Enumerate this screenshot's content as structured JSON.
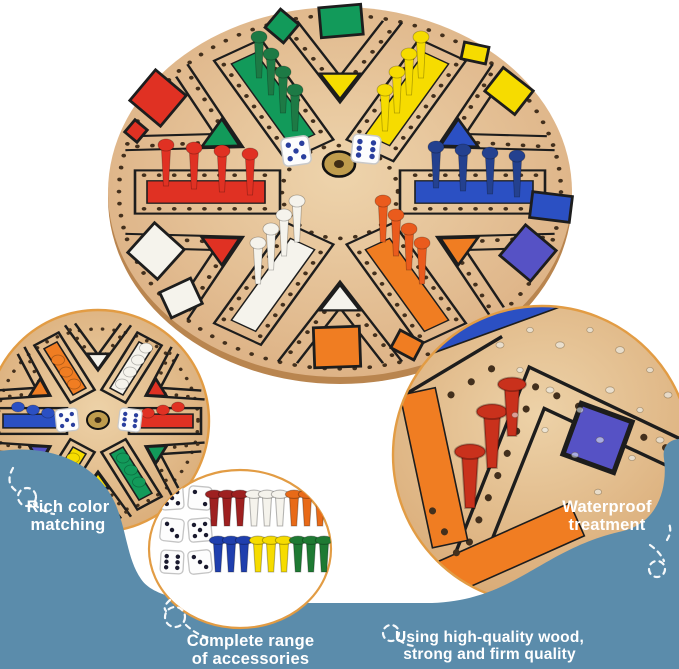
{
  "captions": {
    "rich_color": {
      "line1": "Rich color",
      "line2": "matching"
    },
    "waterproof": {
      "line1": "Waterproof",
      "line2": "treatment"
    },
    "accessories": {
      "line1": "Complete range",
      "line2": "of accessories"
    },
    "quality": {
      "line1": "Using high-quality wood,",
      "line2": "strong and firm quality"
    }
  },
  "colors": {
    "background_blue": "#5b8cab",
    "circle_border": "#e29c44",
    "wood": "#dcb083",
    "wood_light": "#eed4ac",
    "wood_edge": "#b9854f",
    "track": "#1d1d1d",
    "hole": "#43301d",
    "brass": "#bf9c4d",
    "red": "#e03123",
    "dark_red": "#9e2020",
    "green": "#129a5a",
    "yellow": "#f6dc00",
    "blue": "#2b50c3",
    "purple": "#5652c5",
    "orange": "#f07d22",
    "white_piece": "#f5f3ec",
    "dice_pip_blue": "#2a3f9e",
    "dice_pip_dark": "#1a1a2e",
    "swirl": "#ffffff",
    "caption_text": "#ffffff"
  },
  "board": {
    "dice_pips": [
      5,
      6
    ],
    "peg_colors": [
      "red",
      "green",
      "yellow",
      "blue",
      "orange",
      "white"
    ],
    "pegs_per_color": 4,
    "dice_count": 2
  },
  "left_inset": {
    "dice_pips": [
      5,
      6
    ]
  },
  "accessories": {
    "dice_pips": [
      5,
      2,
      3,
      5,
      6,
      3
    ],
    "dice_count": 6,
    "peg_groups_top": [
      "dark_red",
      "white",
      "orange"
    ],
    "peg_groups_bottom": [
      "blue",
      "yellow",
      "green"
    ],
    "pegs_per_group": 3
  }
}
